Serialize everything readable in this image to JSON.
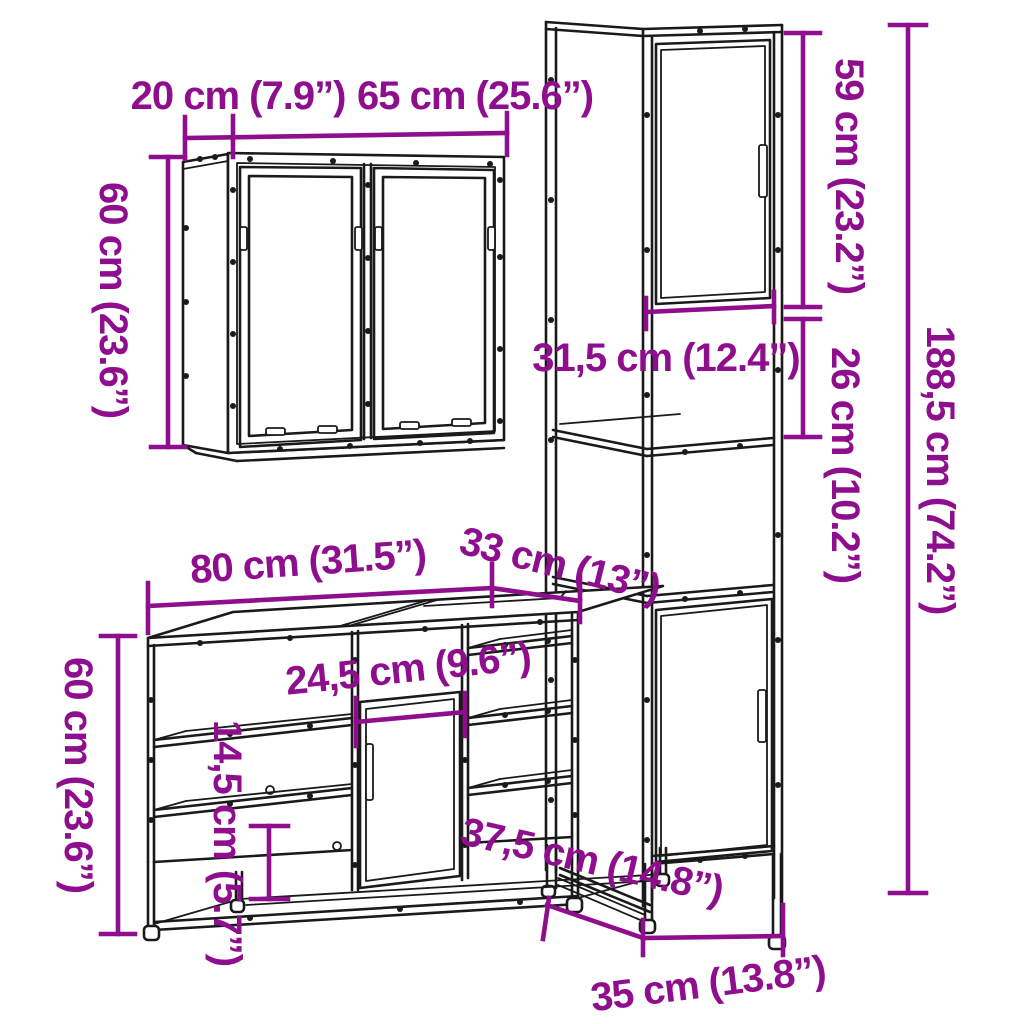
{
  "title": "3 Piece Bathroom Furniture Set dimension diagram",
  "colors": {
    "dimension_annotation": "#8E0E8E",
    "drawing_line": "#1a1a1a",
    "background": "#ffffff"
  },
  "pieces": {
    "mirror_cabinet": {
      "name": "wall mirror cabinet",
      "depth": "20 cm (7.9”)",
      "width": "65 cm (25.6”)",
      "height": "60 cm (23.6”)"
    },
    "tall_cabinet": {
      "name": "tall bathroom cabinet",
      "upper_section_height": "59 cm (23.2”)",
      "open_section_height": "26 cm (10.2”)",
      "total_height": "188,5 cm (74.2”)",
      "inner_width": "31,5 cm (12.4”)",
      "depth": "37,5 cm (14.8”)",
      "width": "35 cm (13.8”)"
    },
    "vanity_cabinet": {
      "name": "bathroom sink cabinet",
      "width": "80 cm (31.5”)",
      "depth": "33 cm (13”)",
      "height": "60 cm (23.6”)",
      "middle_door_width": "24,5 cm (9.6”)",
      "lower_compartment_height": "14,5 cm (5.7”)"
    }
  }
}
